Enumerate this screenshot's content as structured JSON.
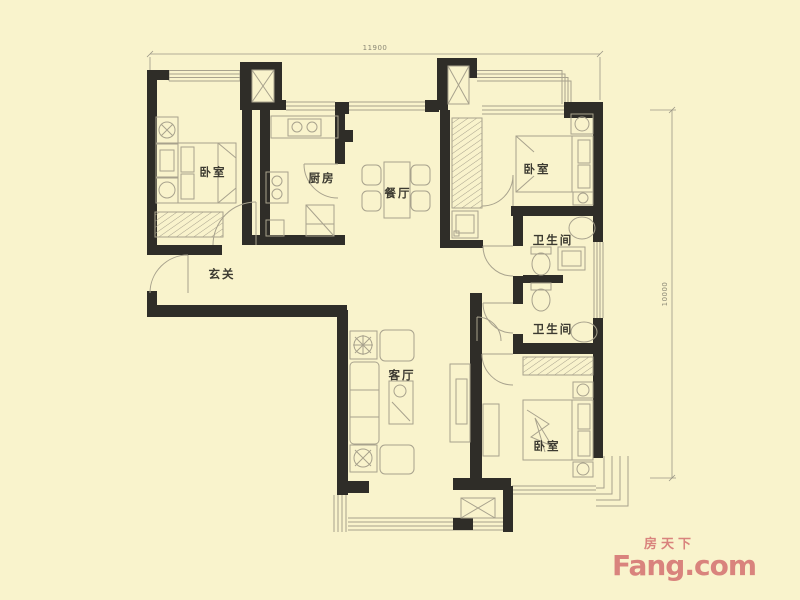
{
  "colors": {
    "bg": "#F9F3CC",
    "wall": "#2F2D28",
    "line": "#A8A28D",
    "label": "#3C3A31",
    "dim": "#9B9786",
    "dimtext": "#8A8775",
    "logo": "#D9837D"
  },
  "dimensions": {
    "width_mm": "11900",
    "height_mm": "10000"
  },
  "rooms": [
    {
      "name": "bedroom-left",
      "label": "卧室"
    },
    {
      "name": "kitchen",
      "label": "厨房"
    },
    {
      "name": "dining-room",
      "label": "餐厅"
    },
    {
      "name": "entry-hall",
      "label": "玄关"
    },
    {
      "name": "bedroom-top-right",
      "label": "卧室"
    },
    {
      "name": "bathroom-upper",
      "label": "卫生间"
    },
    {
      "name": "bathroom-lower",
      "label": "卫生间"
    },
    {
      "name": "living-room",
      "label": "客厅"
    },
    {
      "name": "bedroom-bottom-right",
      "label": "卧室"
    }
  ],
  "watermark": {
    "chinese": "房天下",
    "brand": "Fang.com"
  }
}
